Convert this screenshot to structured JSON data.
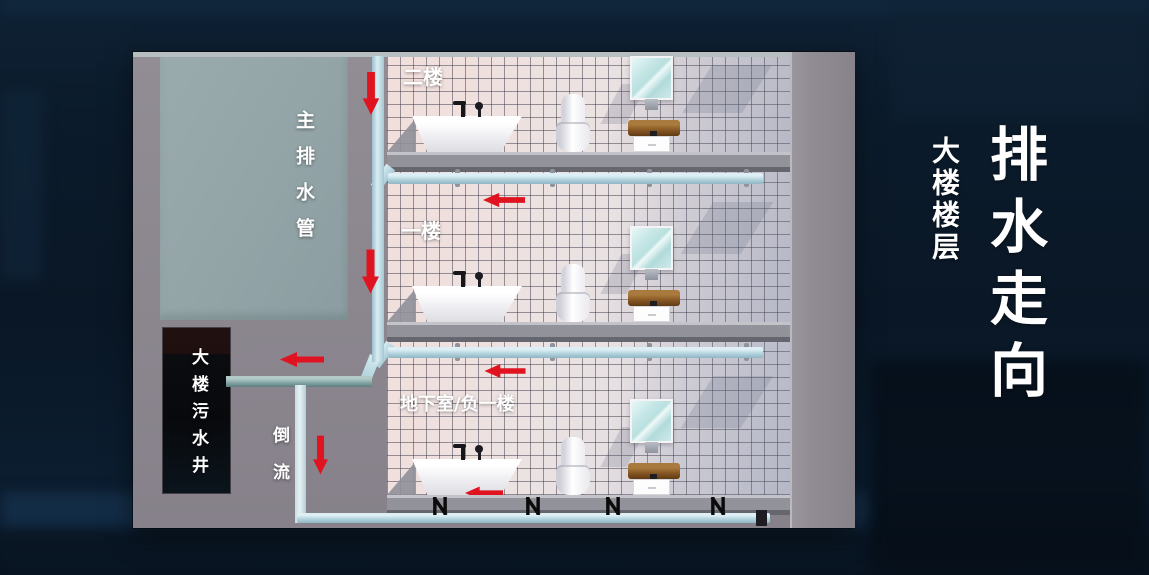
{
  "page_title": {
    "main_title": "排水走向",
    "subtitle": "大楼楼层"
  },
  "diagram": {
    "labels": {
      "main_drain": "主排水管",
      "sewage_well": "大楼污水井",
      "backflow": "倒流"
    },
    "floors": [
      {
        "id": "floor-2",
        "label": "二楼"
      },
      {
        "id": "floor-1",
        "label": "一楼"
      },
      {
        "id": "basement",
        "label": "地下室/负一楼"
      }
    ],
    "colors": {
      "background_navy": "#0b1b2b",
      "concrete_gray": "#8d8890",
      "main_drain_green": "#93a4a7",
      "pipe_light_blue": "#b2d3dd",
      "sewage_pipe_teal": "#7fa1a1",
      "arrow_red": "#e01420",
      "sewage_well_black": "#0a0c10",
      "tile_pink_white": "#eae2e2",
      "title_white": "#ffffff"
    }
  }
}
